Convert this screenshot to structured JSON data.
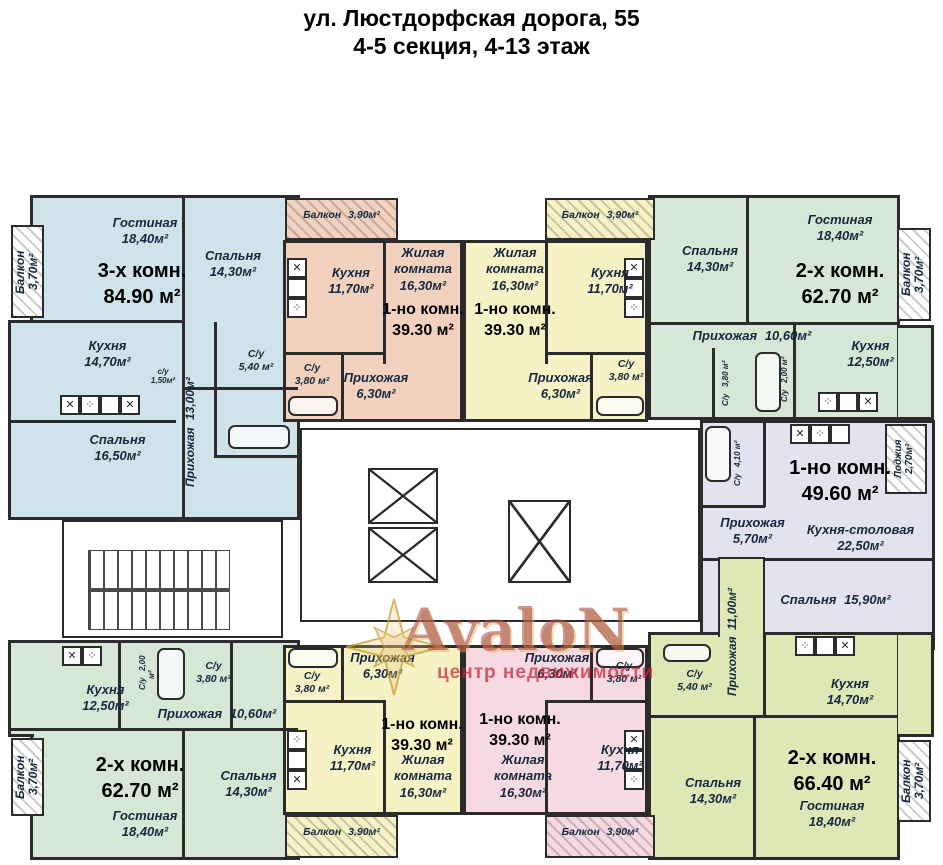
{
  "title": {
    "line1": "ул. Люстдорфская дорога, 55",
    "line2": "4-5 секция, 4-13 этаж"
  },
  "watermark": {
    "brand": "AvaloN",
    "tagline": "центр недвижимости"
  },
  "core": {
    "elevators": 3,
    "stairs": 1
  },
  "apartments": [
    {
      "id": "blue-top-left",
      "type": "3-х комн.",
      "total": "84.90 м²",
      "color": "#cfe3eb",
      "rooms": [
        {
          "name": "Гостиная",
          "area": "18,40м²"
        },
        {
          "name": "Спальня",
          "area": "14,30м²"
        },
        {
          "name": "Кухня",
          "area": "14,70м²"
        },
        {
          "name": "Спальня",
          "area": "16,50м²"
        },
        {
          "name": "Прихожая",
          "area": "13,00м²"
        },
        {
          "name": "С/у",
          "area": "5,40 м²"
        },
        {
          "name": "с/у",
          "area": "1,50м²"
        },
        {
          "name": "Балкон",
          "area": "3,70м²"
        }
      ]
    },
    {
      "id": "orange-top",
      "type": "1-но комн.",
      "total": "39.30 м²",
      "color": "#f2d2bf",
      "rooms": [
        {
          "name": "Балкон",
          "area": "3,90м²"
        },
        {
          "name": "Кухня",
          "area": "11,70м²"
        },
        {
          "name": "Жилая комната",
          "area": "16,30м²"
        },
        {
          "name": "Прихожая",
          "area": "6,30м²"
        },
        {
          "name": "С/у",
          "area": "3,80 м²"
        }
      ]
    },
    {
      "id": "yellow-top",
      "type": "1-но комн.",
      "total": "39.30 м²",
      "color": "#f6f2c6",
      "rooms": [
        {
          "name": "Балкон",
          "area": "3,90м²"
        },
        {
          "name": "Жилая комната",
          "area": "16,30м²"
        },
        {
          "name": "Кухня",
          "area": "11,70м²"
        },
        {
          "name": "Прихожая",
          "area": "6,30м²"
        },
        {
          "name": "С/у",
          "area": "3,80 м²"
        }
      ]
    },
    {
      "id": "green-top-right",
      "type": "2-х комн.",
      "total": "62.70 м²",
      "color": "#d6e7d5",
      "rooms": [
        {
          "name": "Спальня",
          "area": "14,30м²"
        },
        {
          "name": "Гостиная",
          "area": "18,40м²"
        },
        {
          "name": "Прихожая",
          "area": "10,60м²"
        },
        {
          "name": "Кухня",
          "area": "12,50м²"
        },
        {
          "name": "С/у",
          "area": "3,80 м²"
        },
        {
          "name": "С/у",
          "area": "2,00 м²"
        },
        {
          "name": "Балкон",
          "area": "3,70м²"
        }
      ]
    },
    {
      "id": "lavender-right",
      "type": "1-но комн.",
      "total": "49.60 м²",
      "color": "#e3e3ef",
      "rooms": [
        {
          "name": "Прихожая",
          "area": "5,70м²"
        },
        {
          "name": "Кухня-столовая",
          "area": "22,50м²"
        },
        {
          "name": "Спальня",
          "area": "15,90м²"
        },
        {
          "name": "Лоджия",
          "area": "2,70м²"
        },
        {
          "name": "С/у",
          "area": "4,10 м²"
        }
      ]
    },
    {
      "id": "green-bottom-left",
      "type": "2-х комн.",
      "total": "62.70 м²",
      "color": "#d6e7d5",
      "rooms": [
        {
          "name": "Кухня",
          "area": "12,50м²"
        },
        {
          "name": "Прихожая",
          "area": "10,60м²"
        },
        {
          "name": "Спальня",
          "area": "14,30м²"
        },
        {
          "name": "Гостиная",
          "area": "18,40м²"
        },
        {
          "name": "С/у",
          "area": "3,80 м²"
        },
        {
          "name": "С/у",
          "area": "2,00 м²"
        },
        {
          "name": "Балкон",
          "area": "3,70м²"
        }
      ]
    },
    {
      "id": "yellow-bottom",
      "type": "1-но комн.",
      "total": "39.30 м²",
      "color": "#f6f2c6",
      "rooms": [
        {
          "name": "Прихожая",
          "area": "6,30м²"
        },
        {
          "name": "С/у",
          "area": "3,80 м²"
        },
        {
          "name": "Кухня",
          "area": "11,70м²"
        },
        {
          "name": "Жилая комната",
          "area": "16,30м²"
        },
        {
          "name": "Балкон",
          "area": "3,90м²"
        }
      ]
    },
    {
      "id": "pink-bottom",
      "type": "1-но комн.",
      "total": "39.30 м²",
      "color": "#f7d9e2",
      "rooms": [
        {
          "name": "Прихожая",
          "area": "6,30м²"
        },
        {
          "name": "С/у",
          "area": "3,80 м²"
        },
        {
          "name": "Жилая комната",
          "area": "16,30м²"
        },
        {
          "name": "Кухня",
          "area": "11,70м²"
        },
        {
          "name": "Балкон",
          "area": "3,90м²"
        }
      ]
    },
    {
      "id": "yellowgreen-bottom-right",
      "type": "2-х комн.",
      "total": "66.40 м²",
      "color": "#dde8b6",
      "rooms": [
        {
          "name": "С/у",
          "area": "5,40 м²"
        },
        {
          "name": "Прихожая",
          "area": "11,00м²"
        },
        {
          "name": "Кухня",
          "area": "14,70м²"
        },
        {
          "name": "Спальня",
          "area": "14,30м²"
        },
        {
          "name": "Гостиная",
          "area": "18,40м²"
        },
        {
          "name": "Балкон",
          "area": "3,70м²"
        }
      ]
    }
  ]
}
